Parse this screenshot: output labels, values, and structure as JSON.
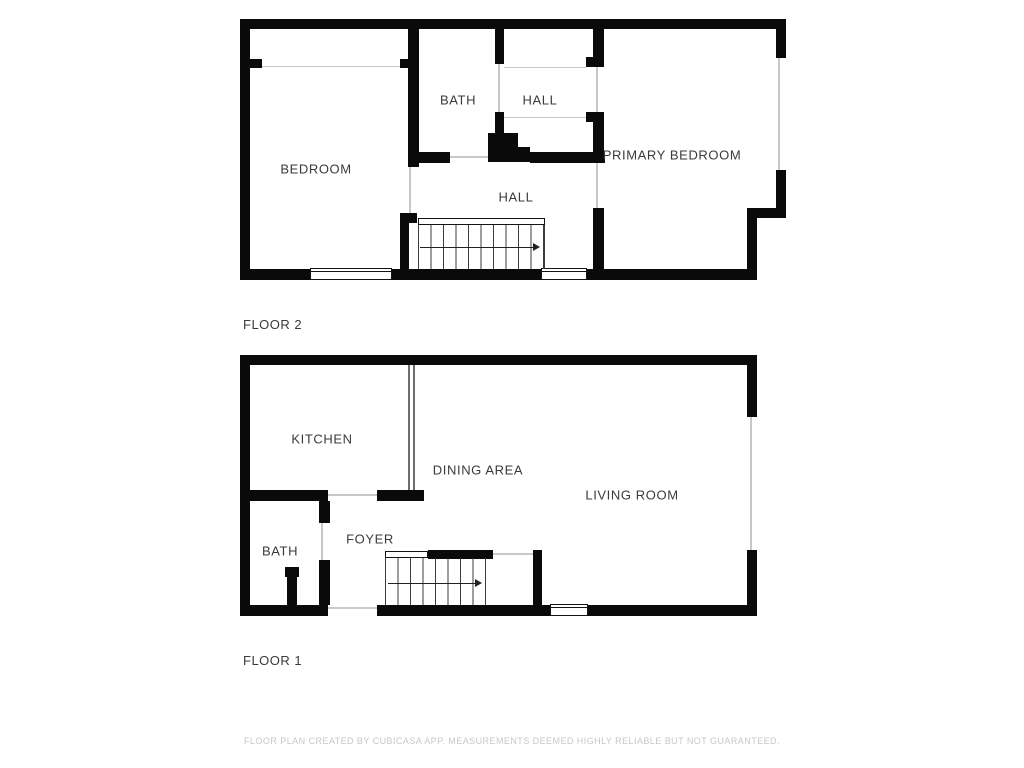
{
  "document": {
    "type": "floor-plan",
    "creator_note": "FLOOR PLAN CREATED BY CUBICASA APP. MEASUREMENTS DEEMED HIGHLY RELIABLE BUT NOT GUARANTEED."
  },
  "floor2": {
    "title": "FLOOR 2",
    "rooms": {
      "bedroom": "BEDROOM",
      "bath": "BATH",
      "hall_upper": "HALL",
      "primary_bedroom": "PRIMARY BEDROOM",
      "hall_lower": "HALL"
    },
    "stairs_direction": "right"
  },
  "floor1": {
    "title": "FLOOR 1",
    "rooms": {
      "kitchen": "KITCHEN",
      "dining_area": "DINING AREA",
      "living_room": "LIVING ROOM",
      "bath": "BATH",
      "foyer": "FOYER"
    },
    "stairs_direction": "right"
  },
  "colors": {
    "wall": "#0a0a0a",
    "background": "#ffffff",
    "label_text": "#3a3a3a",
    "disclaimer_text": "#c7c7c7"
  }
}
